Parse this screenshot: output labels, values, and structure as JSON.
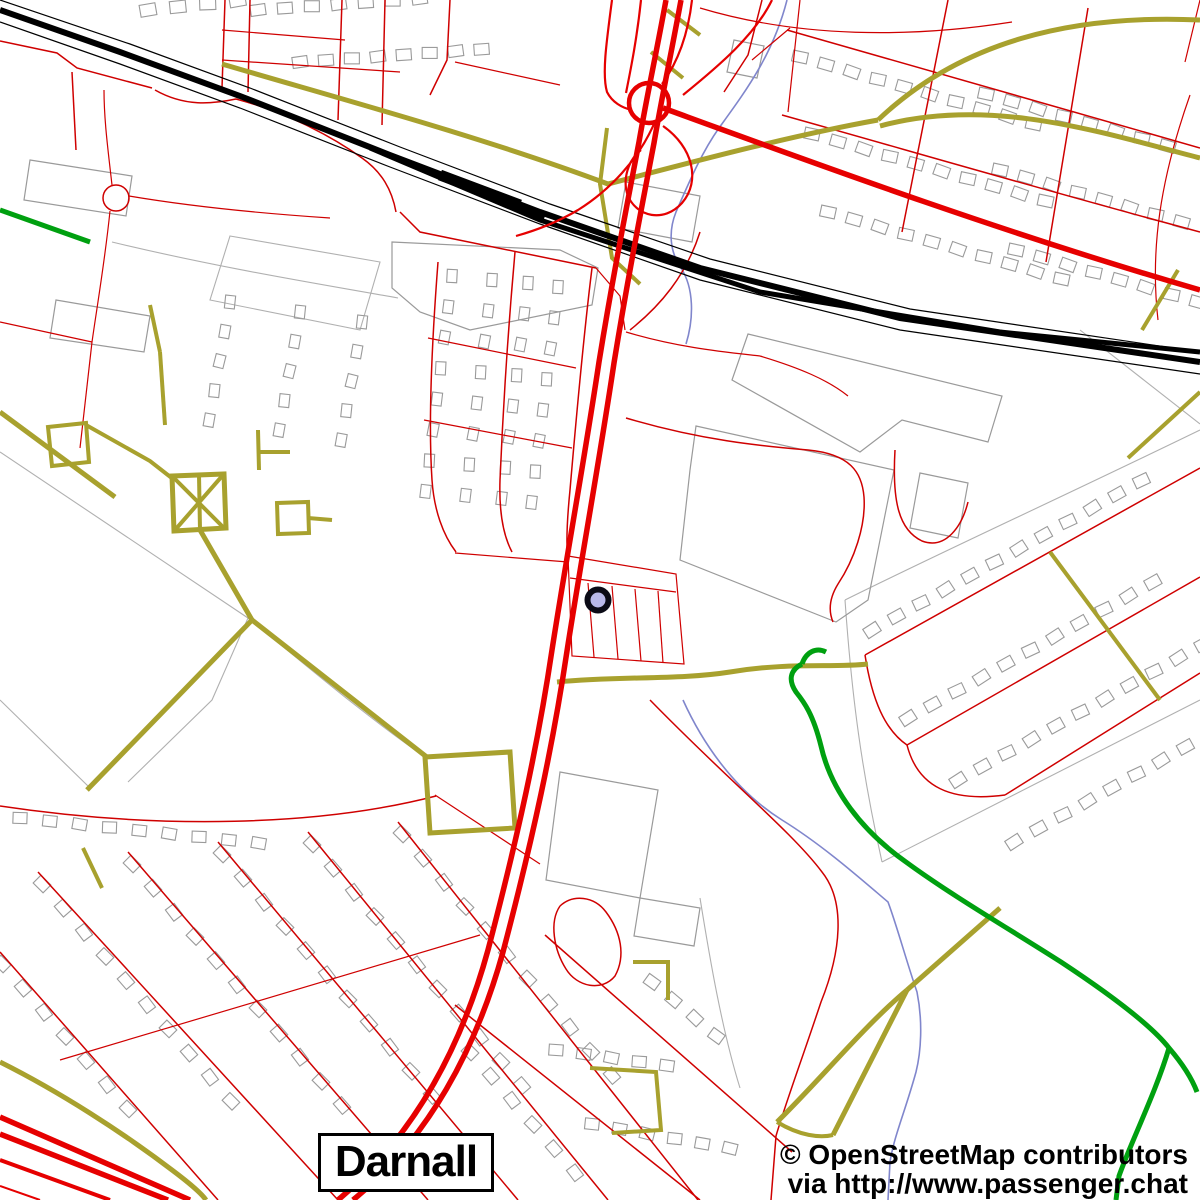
{
  "map": {
    "place_label": "Darnall",
    "attribution_line1": "© OpenStreetMap contributors",
    "attribution_line2": "via http://www.passenger.chat",
    "marker": {
      "x": 598,
      "y": 600,
      "radius": 10.5,
      "ring_width": 6,
      "fill": "#b9b9ea",
      "ring": "#0b0b16"
    },
    "colors": {
      "bg": "#ffffff",
      "motorway": "#e60000",
      "street": "#cf0000",
      "path": "#a8a12e",
      "green": "#00a010",
      "rail": "#000000",
      "water": "#8086cc",
      "building": "#9a9a9a",
      "parcel": "#b0b0b0"
    },
    "building_rows": [
      {
        "x": 258,
        "y": 10,
        "a": -4,
        "n": 7,
        "w": 15,
        "h": 11,
        "g": 27
      },
      {
        "x": 300,
        "y": 62,
        "a": -4,
        "n": 8,
        "w": 15,
        "h": 11,
        "g": 26
      },
      {
        "x": 148,
        "y": 10,
        "a": -6,
        "n": 4,
        "w": 16,
        "h": 12,
        "g": 30
      },
      {
        "x": 452,
        "y": 276,
        "a": 97,
        "n": 8,
        "w": 13,
        "h": 10,
        "g": 31
      },
      {
        "x": 492,
        "y": 280,
        "a": 97,
        "n": 8,
        "w": 13,
        "h": 10,
        "g": 31
      },
      {
        "x": 528,
        "y": 283,
        "a": 97,
        "n": 8,
        "w": 13,
        "h": 10,
        "g": 31
      },
      {
        "x": 558,
        "y": 287,
        "a": 97,
        "n": 8,
        "w": 13,
        "h": 10,
        "g": 31
      },
      {
        "x": 230,
        "y": 302,
        "a": 100,
        "n": 5,
        "w": 13,
        "h": 10,
        "g": 30
      },
      {
        "x": 300,
        "y": 312,
        "a": 100,
        "n": 5,
        "w": 13,
        "h": 10,
        "g": 30
      },
      {
        "x": 362,
        "y": 322,
        "a": 100,
        "n": 5,
        "w": 13,
        "h": 10,
        "g": 30
      },
      {
        "x": 800,
        "y": 57,
        "a": 16,
        "n": 10,
        "w": 15,
        "h": 11,
        "g": 27
      },
      {
        "x": 812,
        "y": 134,
        "a": 16,
        "n": 10,
        "w": 15,
        "h": 11,
        "g": 27
      },
      {
        "x": 828,
        "y": 212,
        "a": 16,
        "n": 10,
        "w": 15,
        "h": 11,
        "g": 27
      },
      {
        "x": 986,
        "y": 94,
        "a": 16,
        "n": 8,
        "w": 15,
        "h": 11,
        "g": 27
      },
      {
        "x": 1000,
        "y": 170,
        "a": 16,
        "n": 8,
        "w": 15,
        "h": 11,
        "g": 27
      },
      {
        "x": 1016,
        "y": 250,
        "a": 16,
        "n": 8,
        "w": 15,
        "h": 11,
        "g": 27
      },
      {
        "x": 872,
        "y": 630,
        "a": -29,
        "n": 12,
        "w": 15,
        "h": 11,
        "g": 28
      },
      {
        "x": 908,
        "y": 718,
        "a": -29,
        "n": 11,
        "w": 15,
        "h": 11,
        "g": 28
      },
      {
        "x": 958,
        "y": 780,
        "a": -29,
        "n": 11,
        "w": 15,
        "h": 11,
        "g": 28
      },
      {
        "x": 1014,
        "y": 842,
        "a": -29,
        "n": 10,
        "w": 15,
        "h": 11,
        "g": 28
      },
      {
        "x": 132,
        "y": 864,
        "a": 49,
        "n": 11,
        "w": 14,
        "h": 11,
        "g": 32
      },
      {
        "x": 222,
        "y": 854,
        "a": 49,
        "n": 11,
        "w": 14,
        "h": 11,
        "g": 32
      },
      {
        "x": 312,
        "y": 844,
        "a": 49,
        "n": 11,
        "w": 14,
        "h": 11,
        "g": 32
      },
      {
        "x": 402,
        "y": 834,
        "a": 49,
        "n": 11,
        "w": 14,
        "h": 11,
        "g": 32
      },
      {
        "x": 42,
        "y": 884,
        "a": 49,
        "n": 10,
        "w": 14,
        "h": 11,
        "g": 32
      },
      {
        "x": 2,
        "y": 964,
        "a": 49,
        "n": 7,
        "w": 14,
        "h": 11,
        "g": 32
      },
      {
        "x": 20,
        "y": 818,
        "a": 6,
        "n": 9,
        "w": 14,
        "h": 11,
        "g": 30
      },
      {
        "x": 470,
        "y": 1052,
        "a": 49,
        "n": 6,
        "w": 14,
        "h": 11,
        "g": 32
      },
      {
        "x": 556,
        "y": 1050,
        "a": 8,
        "n": 5,
        "w": 14,
        "h": 11,
        "g": 28
      },
      {
        "x": 592,
        "y": 1124,
        "a": 10,
        "n": 6,
        "w": 14,
        "h": 11,
        "g": 28
      },
      {
        "x": 652,
        "y": 982,
        "a": 40,
        "n": 4,
        "w": 14,
        "h": 11,
        "g": 28
      }
    ]
  }
}
